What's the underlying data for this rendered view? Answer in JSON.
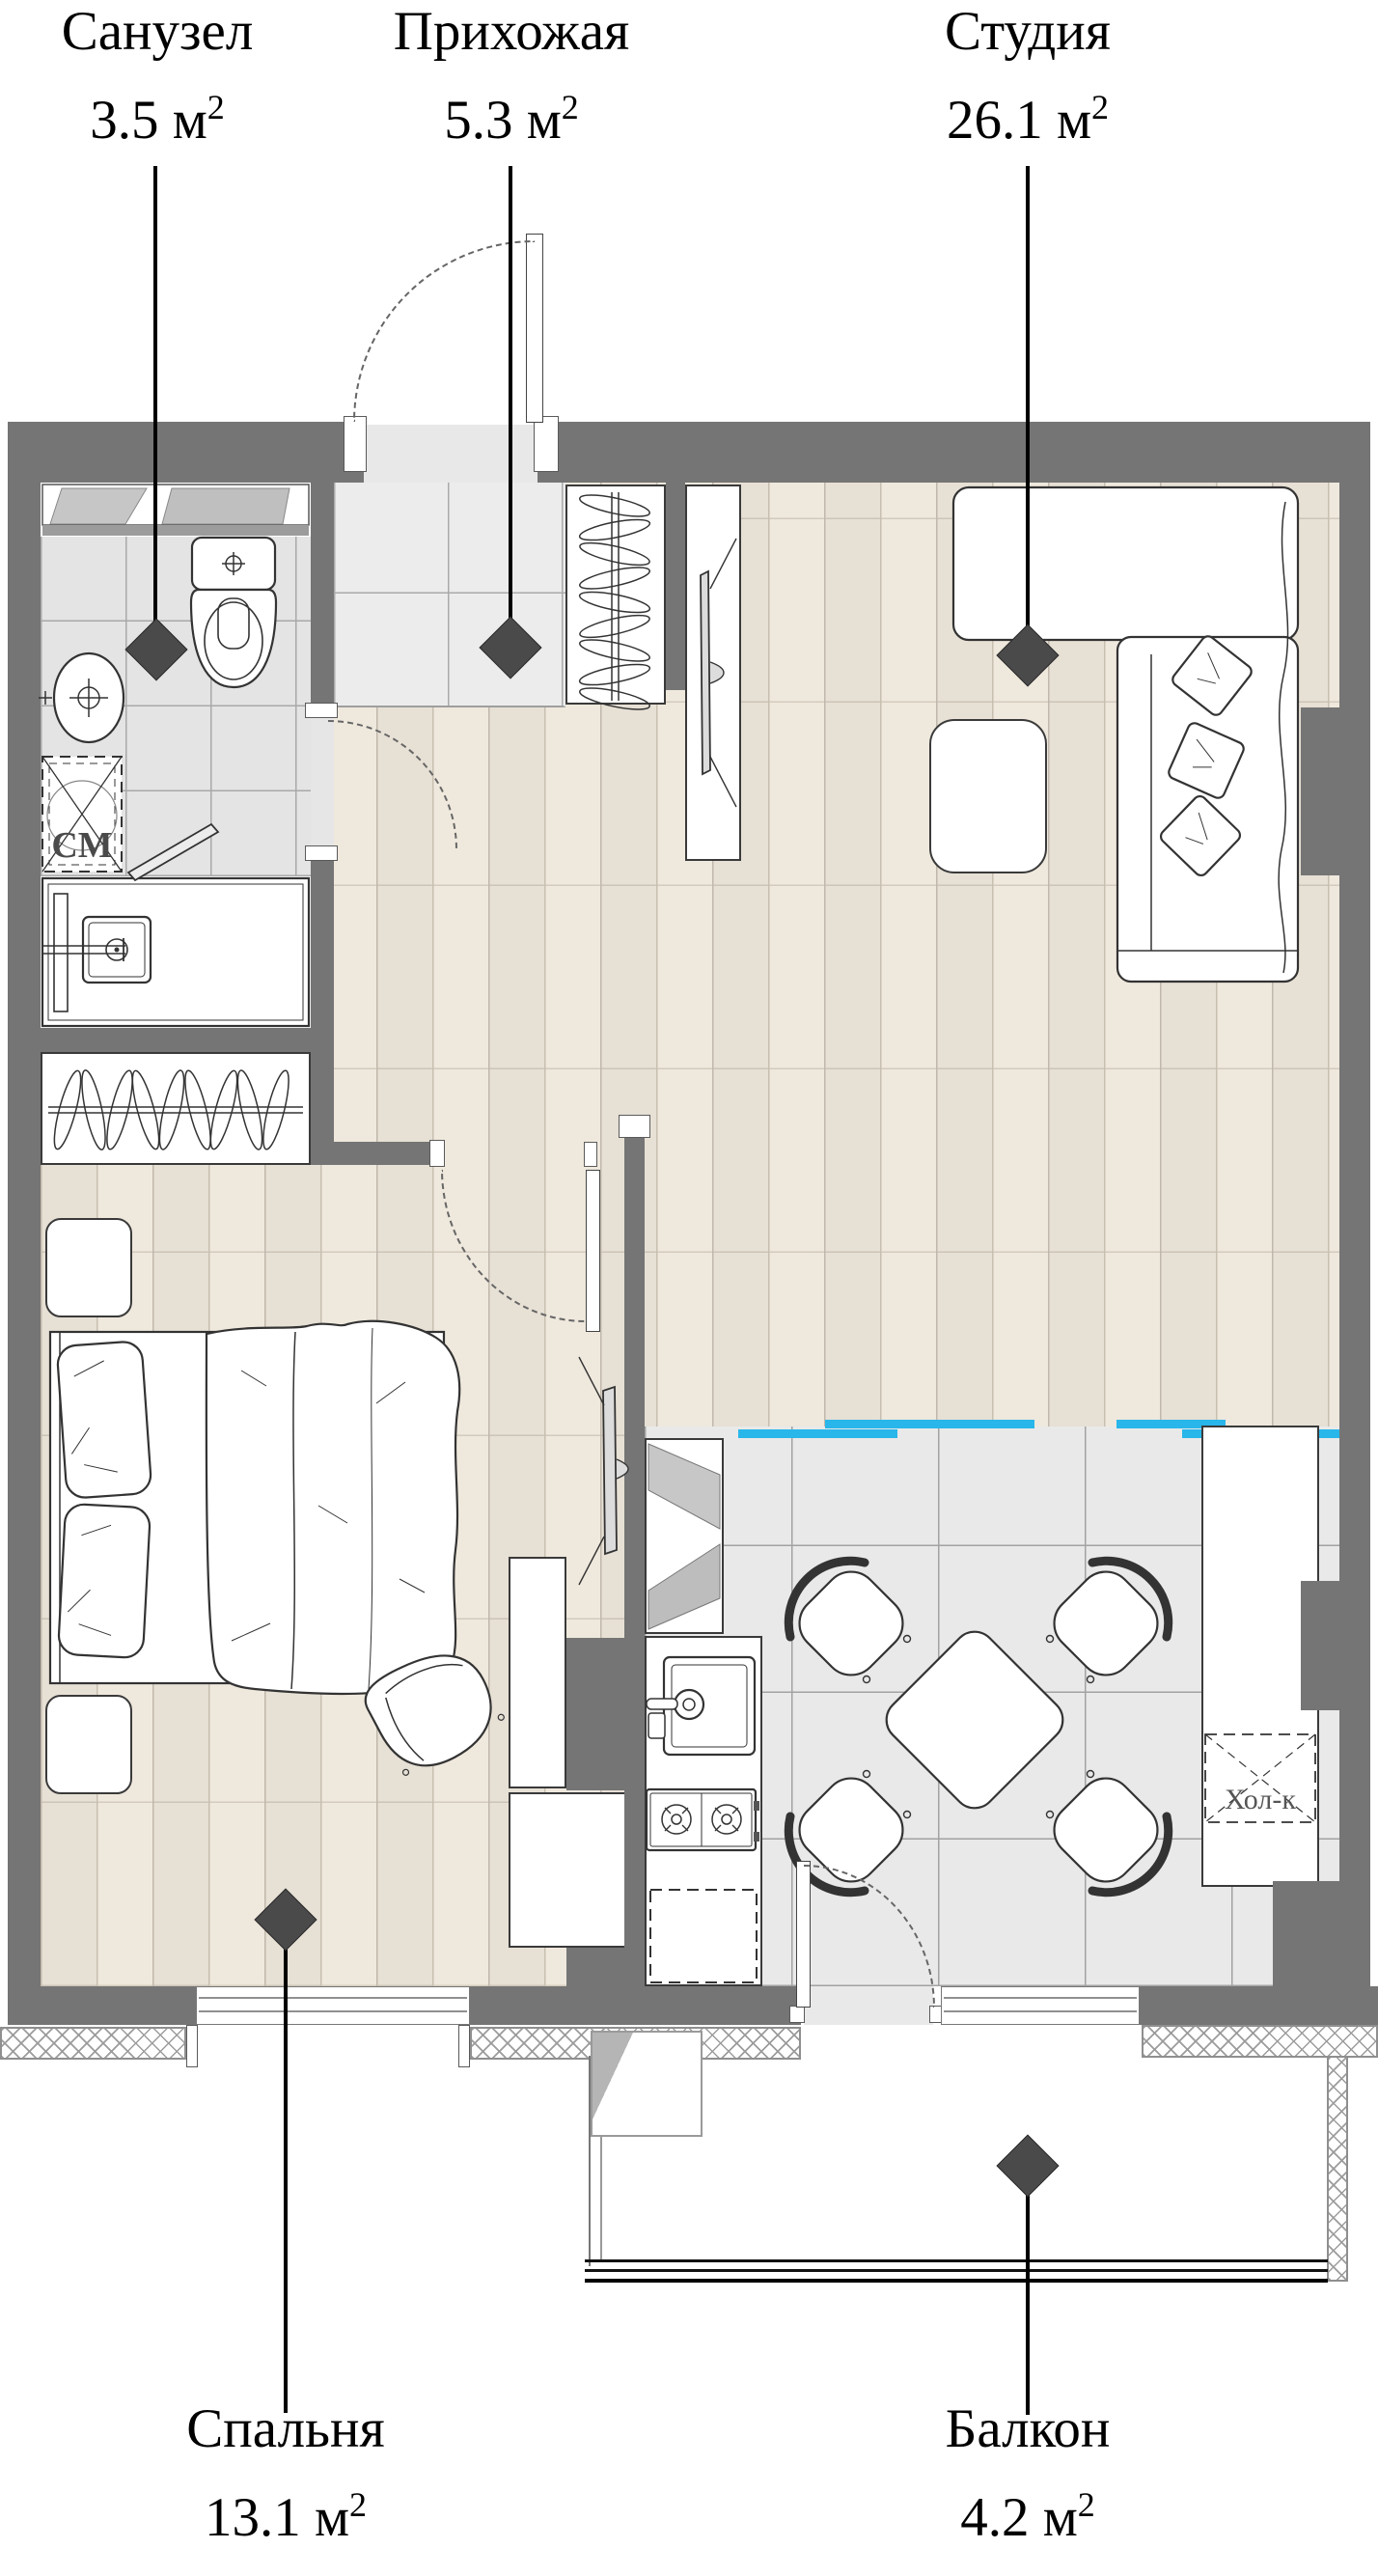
{
  "rooms": [
    {
      "id": "bathroom",
      "name": "Санузел",
      "area": "3.5"
    },
    {
      "id": "hallway",
      "name": "Прихожая",
      "area": "5.3"
    },
    {
      "id": "studio",
      "name": "Студия",
      "area": "26.1"
    },
    {
      "id": "bedroom",
      "name": "Спальня",
      "area": "13.1"
    },
    {
      "id": "balcony",
      "name": "Балкон",
      "area": "4.2"
    }
  ],
  "units": {
    "base": "м",
    "sup": "2"
  },
  "appliances": {
    "washer": "СМ",
    "fridge": "Хол-к"
  },
  "colors": {
    "wall": "#757575",
    "zone": "#29b6ea",
    "marker": "#4a4a4a",
    "wood": "#efe8dd",
    "tile": "#e9e9e9"
  }
}
